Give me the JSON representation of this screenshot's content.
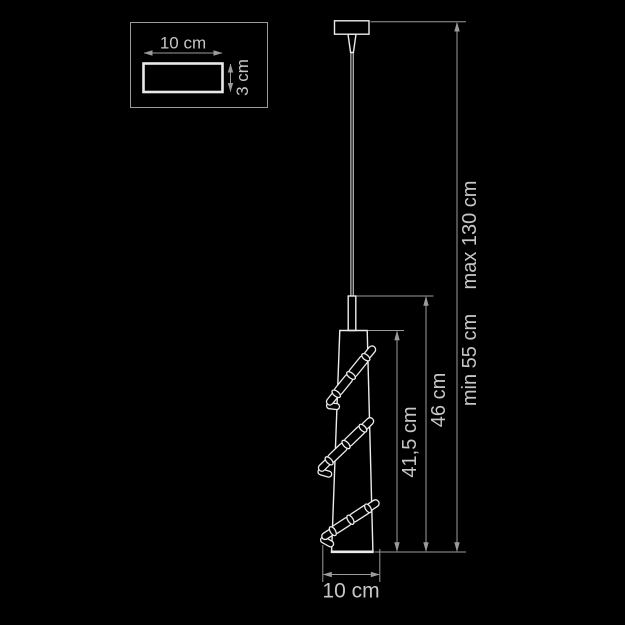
{
  "colors": {
    "background": "#000000",
    "lamp_line": "#ebebeb",
    "dimension_line": "#9b9b9b",
    "label_text": "#c6c6c6"
  },
  "canopy_detail": {
    "width_label": "10 cm",
    "depth_label": "3 cm"
  },
  "labels": {
    "max_suspension": "max 130 cm",
    "min_suspension": "min 55 cm",
    "fixture_height": "46 cm",
    "shade_height": "41,5 cm",
    "shade_diameter": "10 cm"
  }
}
